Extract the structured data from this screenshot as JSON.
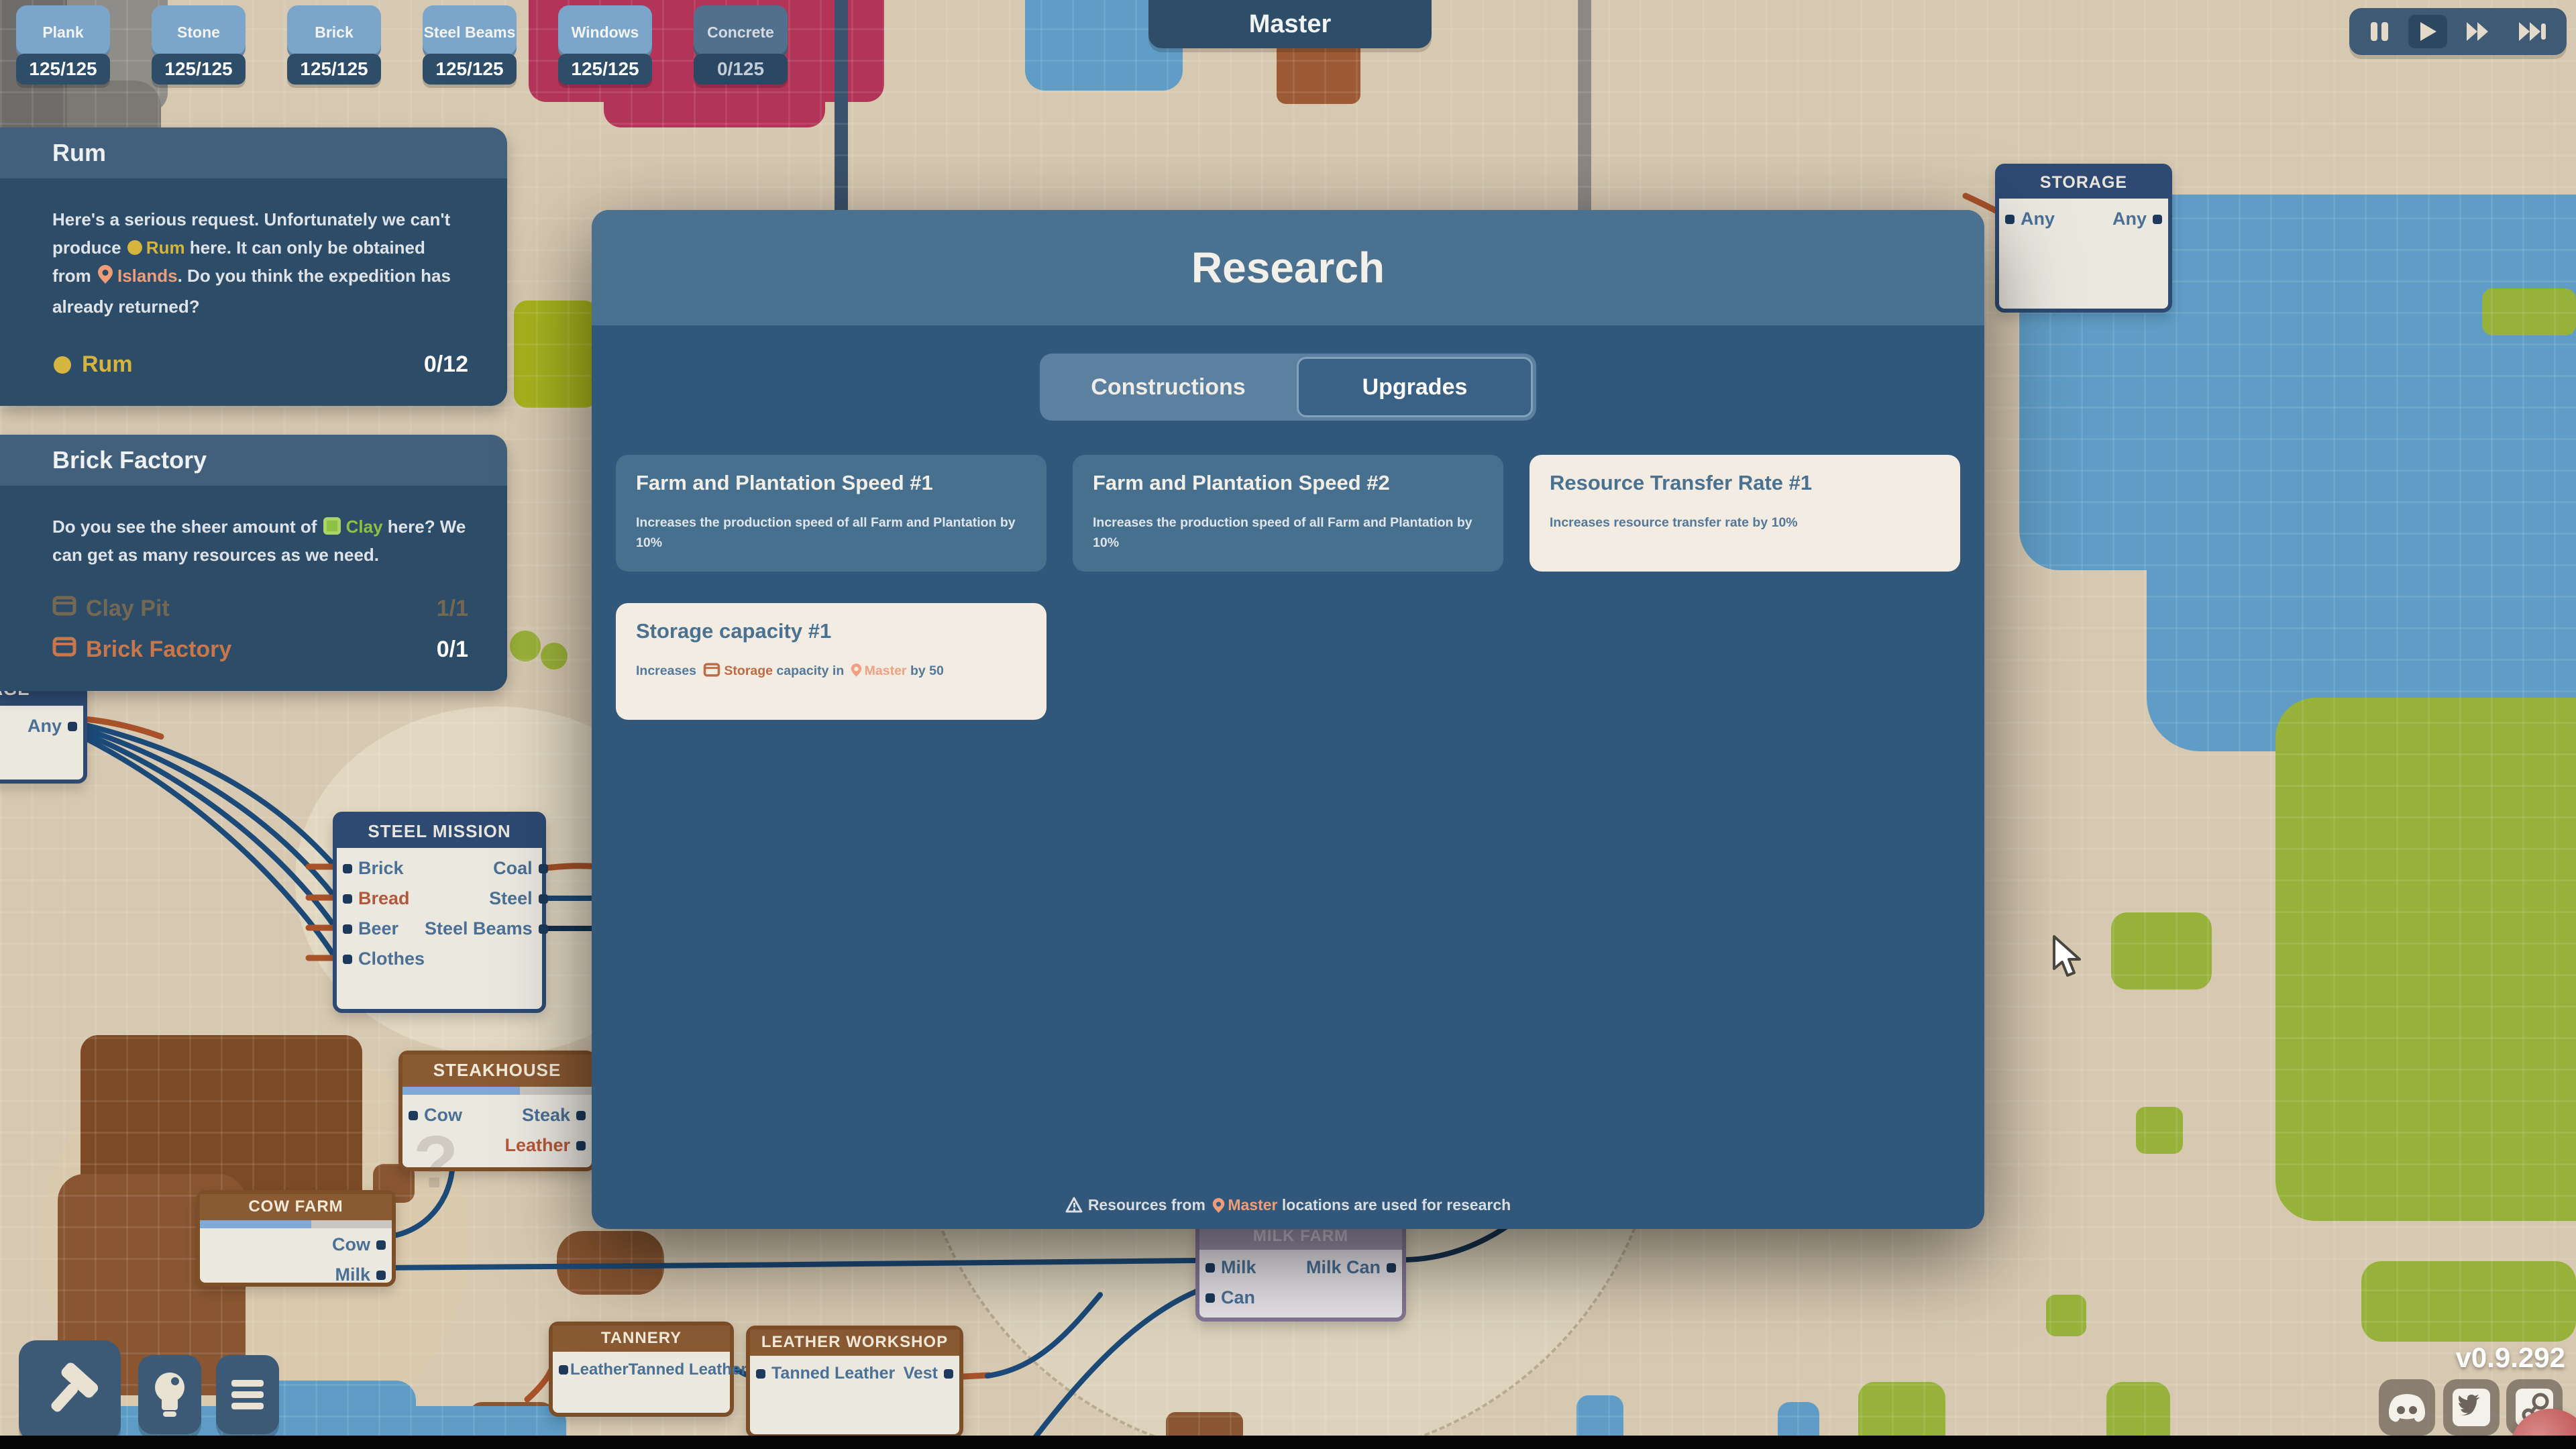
{
  "app": {
    "version_label": "v0.9.292",
    "location_label": "Master",
    "playground_stamp": "PLAYGROUND"
  },
  "colors": {
    "modal_header": "#4b7191",
    "modal_body": "#31577a",
    "card_light": "#f2ece3",
    "card_blue": "#47708f",
    "accent_yellow": "#d6b53e",
    "accent_salmon": "#ef9d79",
    "accent_green": "#8fc046",
    "accent_orange": "#bf6b44",
    "node_navy": "#2e4a72",
    "node_brown": "#8a5a33",
    "node_purple": "#9d94ad",
    "wire_blue": "#1c4a78",
    "wire_orange": "#a8522a",
    "map_water": "#5f9dc6",
    "map_grass": "#97b23a",
    "map_dirt": "#8a5631",
    "map_magenta": "#b23458"
  },
  "resource_counters": [
    {
      "name": "Plank",
      "value": "125/125"
    },
    {
      "name": "Stone",
      "value": "125/125"
    },
    {
      "name": "Brick",
      "value": "125/125"
    },
    {
      "name": "Steel Beams",
      "value": "125/125"
    },
    {
      "name": "Windows",
      "value": "125/125"
    },
    {
      "name": "Concrete",
      "value": "0/125"
    }
  ],
  "playback": {
    "buttons": [
      "pause-icon",
      "play-icon",
      "fast-forward-icon",
      "max-forward-icon"
    ],
    "active": "play"
  },
  "quest_rum": {
    "title": "Rum",
    "seg1": "Here's a serious request. Unfortunately we can't produce ",
    "seg2": "Rum",
    "seg3": " here. It can only be obtained from ",
    "seg4": "Islands",
    "seg5": ". Do you think the expedition has already returned?",
    "reward_name": "Rum",
    "reward_progress": "0/12"
  },
  "quest_brick": {
    "title": "Brick Factory",
    "seg1": "Do you see the sheer amount of ",
    "seg2": "Clay",
    "seg3": " here? We can get as many resources as we need.",
    "objectives": [
      {
        "name": "Clay Pit",
        "progress": "1/1",
        "done": true
      },
      {
        "name": "Brick Factory",
        "progress": "0/1",
        "done": false
      }
    ]
  },
  "research": {
    "title": "Research",
    "tab_constructions": "Constructions",
    "tab_upgrades": "Upgrades",
    "active_tab": "Upgrades",
    "cards": [
      {
        "title": "Farm and Plantation Speed #1",
        "desc": "Increases the production speed of all Farm and Plantation by 10%",
        "style": "blue"
      },
      {
        "title": "Farm and Plantation Speed #2",
        "desc": "Increases the production speed of all Farm and Plantation by 10%",
        "style": "blue"
      },
      {
        "title": "Resource Transfer Rate #1",
        "desc": "Increases resource transfer rate by 10%",
        "style": "light"
      },
      {
        "title": "Storage capacity #1",
        "style": "light",
        "seg1": "Increases ",
        "seg2": "Storage",
        "seg3": " capacity in ",
        "seg4": "Master",
        "seg5": " by 50"
      }
    ],
    "footer_seg1": "Resources from ",
    "footer_seg2": "Master",
    "footer_seg3": " locations are used for research"
  },
  "nodes": {
    "steel_mission": {
      "title": "STEEL MISSION",
      "in1": "Brick",
      "in2": "Bread",
      "in3": "Beer",
      "in4": "Clothes",
      "out1": "Coal",
      "out2": "Steel",
      "out3": "Steel Beams"
    },
    "steakhouse": {
      "title": "STEAKHOUSE",
      "in1": "Cow",
      "out1": "Steak",
      "out2": "Leather",
      "hint": "?",
      "progress_pct": 62
    },
    "cow_farm": {
      "title": "COW FARM",
      "out1": "Cow",
      "out2": "Milk",
      "progress_pct": 58
    },
    "milk_farm": {
      "title": "MILK FARM",
      "in1": "Milk",
      "in2": "Can",
      "out1": "Milk Can"
    },
    "tannery": {
      "title": "TANNERY",
      "in1": "Leather",
      "out1": "Tanned Leather"
    },
    "leather_workshop": {
      "title": "LEATHER WORKSHOP",
      "in1": "Tanned Leather",
      "out1": "Vest"
    },
    "storage": {
      "title": "STORAGE",
      "in1": "Any",
      "out1": "Any"
    },
    "storage_left": {
      "title": "STORAGE",
      "out1": "Any"
    }
  },
  "hud": {
    "build_icon": "hammer-icon",
    "research_icon": "lightbulb-icon",
    "menu_icon": "menu-icon",
    "social_icons": [
      "discord-icon",
      "twitter-icon",
      "steam-icon"
    ]
  }
}
